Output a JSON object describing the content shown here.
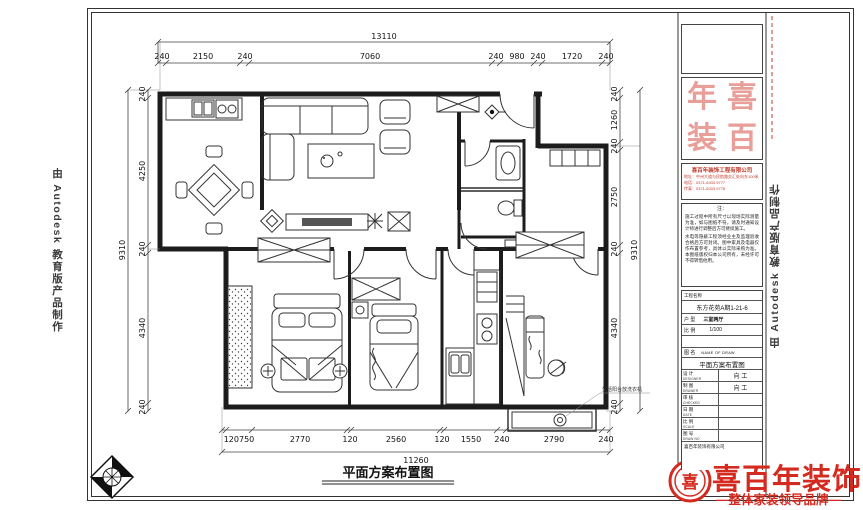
{
  "watermark": {
    "text": "由 Autodesk 教育版产品制作"
  },
  "caption": "平面方案布置图",
  "plan": {
    "annotation": "生活阳台放洗衣机"
  },
  "dims": {
    "top_total": "13110",
    "top": [
      "240",
      "2150",
      "240",
      "7060",
      "240",
      "980",
      "240",
      "1720",
      "240"
    ],
    "left": [
      "240",
      "4250",
      "240",
      "4340",
      "240"
    ],
    "left_total": "9310",
    "right": [
      "240",
      "1260",
      "240",
      "2750",
      "240",
      "4340",
      "240"
    ],
    "right_total": "9310",
    "bottom": [
      "120750",
      "2770",
      "120",
      "2560",
      "120",
      "1550",
      "240",
      "2790",
      "240"
    ],
    "bottom_total": "11260"
  },
  "title_block": {
    "stamp": [
      "年",
      "喜",
      "装",
      "百"
    ],
    "company": {
      "name": "喜百年装饰工程有限公司",
      "addr": "地址：中州大道与民航路交汇处向东100米",
      "tel": "电话：0371-6333 9777",
      "fax": "传真：0371-6333 9778"
    },
    "notes": {
      "header": "注：",
      "p1": "施工过程中所有尺寸以现场实际测量为准，如与图纸不符，请及时通知设计师进行调整后方可继续施工。",
      "p2": "水电等隐蔽工程须经业主及监理验收合格后方可封闭。图中家具及电器仅作布置参考，具体以实际采购为准。本图纸版权归本公司所有，未经许可不得转借他用。"
    },
    "project_label": "工程名称",
    "project_value": "东方花苑A期1-21-6",
    "type_label": "户 型",
    "type_value": "三室两厅",
    "scale_label": "比 例",
    "scale_value": "1/100",
    "imgname_label": "图 名",
    "imgname_en": "NAME OF DRAW",
    "drawing_title": "平面方案布置图",
    "rows": [
      {
        "zh": "设 计",
        "en": "DESIGNER",
        "val": "向 工"
      },
      {
        "zh": "制 图",
        "en": "DRAWER",
        "val": "向 工"
      },
      {
        "zh": "审 核",
        "en": "CHECKED",
        "val": ""
      },
      {
        "zh": "日 期",
        "en": "DATE",
        "val": ""
      },
      {
        "zh": "比 例",
        "en": "SCALE",
        "val": ""
      },
      {
        "zh": "图 号",
        "en": "DRAW NO",
        "val": ""
      }
    ],
    "footer": "喜百年装饰有限公司"
  },
  "logo": {
    "emblem_char": "喜",
    "name": "喜百年装饰",
    "tagline": "—整体家装领导品牌—",
    "color": "#d42b20"
  }
}
